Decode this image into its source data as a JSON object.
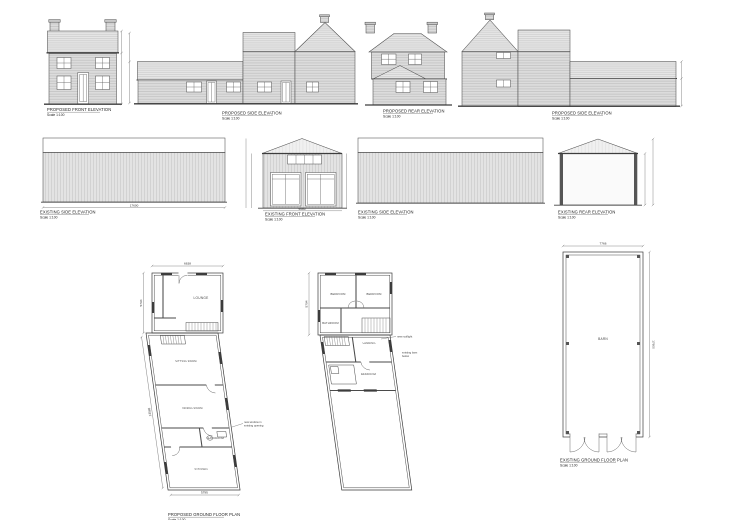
{
  "sheet": {
    "background": "#ffffff"
  },
  "palette": {
    "line": "#4d4d4d",
    "wall_hatch": "#dcdcdc",
    "roof_hatch": "#e7e7e7",
    "cladding": "#e3e3e3",
    "dark_bar": "#3c3c3c"
  },
  "drawings": {
    "proposed_front": {
      "title": "PROPOSED FRONT ELEVATION",
      "scale": "Scale 1:100"
    },
    "proposed_side_a": {
      "title": "PROPOSED SIDE ELEVATION",
      "scale": "Scale 1:100"
    },
    "proposed_rear": {
      "title": "PROPOSED REAR ELEVATION",
      "scale": "Scale 1:100"
    },
    "proposed_side_b": {
      "title": "PROPOSED SIDE ELEVATION",
      "scale": "Scale 1:100"
    },
    "existing_side_a": {
      "title": "EXISTING SIDE ELEVATION",
      "scale": "Scale 1:100",
      "length_dim": "17600"
    },
    "existing_front": {
      "title": "EXISTING FRONT ELEVATION",
      "scale": "Scale 1:100",
      "width_dim": "5680"
    },
    "existing_side_b": {
      "title": "EXISTING SIDE ELEVATION",
      "scale": "Scale 1:100"
    },
    "existing_rear": {
      "title": "EXISTING REAR ELEVATION",
      "scale": "Scale 1:100"
    },
    "ground_floor_plan": {
      "title": "PROPOSED GROUND FLOOR PLAN",
      "scale": "Scale 1:100",
      "width_dim": "6638",
      "depth_dim": "5794",
      "side_dim": "13565",
      "bottom_dim": "5790",
      "rooms": {
        "lounge": "LOUNGE",
        "sitting": "SITTING ROOM",
        "dining": "DINING ROOM",
        "bathroom": "BATHROOM",
        "kitchen": "KITCHEN"
      },
      "note_line1": "new window in",
      "note_line2": "existing opening"
    },
    "first_floor_plan": {
      "depth_dim": "5794",
      "rooms": {
        "bedroom1": "BEDROOM",
        "bedroom2": "BEDROOM",
        "bathroom": "BATHROOM",
        "landing": "LANDING",
        "bedroom3": "BEDROOM"
      },
      "note1": "new rooflight",
      "note2_line1": "existing barn",
      "note2_line2": "below"
    },
    "barn_plan": {
      "title": "EXISTING GROUND FLOOR PLAN",
      "scale": "Scale 1:100",
      "width_dim": "7766",
      "length_dim": "17600",
      "room": "BARN"
    }
  }
}
